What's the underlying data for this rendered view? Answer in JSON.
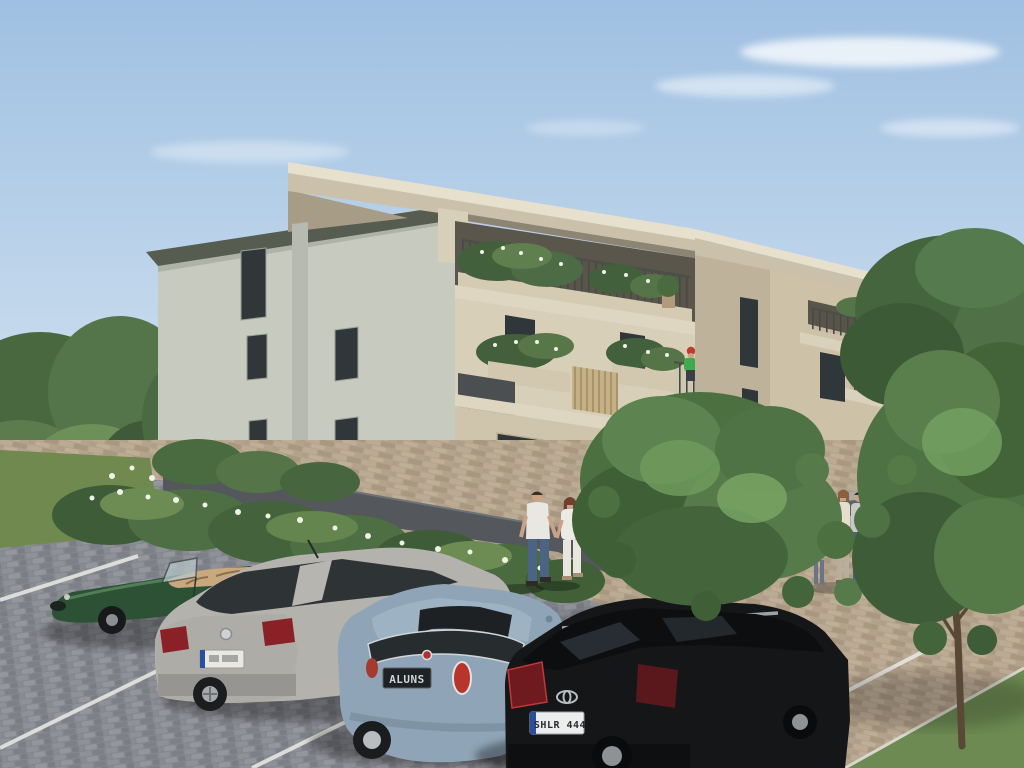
{
  "meta": {
    "type": "architectural-exterior-rendering",
    "title": "3D rendering of a modern three-storey apartment building with landscaped parking area",
    "time_of_day": "sunny daytime, light from upper right"
  },
  "palette": {
    "sky_top": "#9fc0e2",
    "sky_horizon": "#dce9f4",
    "cloud": "#ffffff",
    "building_left_facade": "#c7cabf",
    "building_front_lit": "#d8cfb8",
    "building_front_shade": "#cfc5ac",
    "building_far_wing": "#cdc1a8",
    "spine_wall": "#bfb29a",
    "roof_fascia_beige": "#cbc1aa",
    "roof_top_light": "#e7e0cc",
    "dark_eave_fascia": "#565c50",
    "window_dark": "#30373a",
    "anthracite_parapet": "#4b4f52",
    "wood_slats": "#c6b186",
    "railing": "#454a45",
    "base_plinth_wall": "#54575b",
    "pavement_grey": "#85878e",
    "pavement_tan": "#b3a28c",
    "stall_line_white": "#e6e6e2",
    "grass": "#70894f",
    "foliage_dark": "#3f5c38",
    "foliage_mid": "#547549",
    "foliage_light": "#74a05f",
    "flower_white": "#eef3e6",
    "trunk_brown": "#5d4a38",
    "shadow": "#000000"
  },
  "building": {
    "storeys": 3,
    "style": "contemporary flat overhanging roof slab, recessed loggias",
    "left_facade": {
      "color_name": "pale grey-green stucco",
      "windows": "five narrow dark vertical windows",
      "downspout_pillar": true
    },
    "front_facade": {
      "color_name": "warm beige stucco",
      "wings": 2
    },
    "balconies": {
      "railing": "thin dark metal balusters",
      "planters": "lush green shrubs with white blooms",
      "features": [
        "anthracite parapet panels",
        "vertical wood-slat privacy screens",
        "terracotta potted plants"
      ]
    },
    "plinth": {
      "color_name": "dark anthracite retaining wall",
      "hedge": "green hedge with white flowers in front"
    },
    "person_on_balcony": {
      "floor": "second",
      "shirt": "green",
      "cap": "red",
      "activity": "tending balcony plants"
    }
  },
  "vehicles": [
    {
      "name": "classic roadster",
      "style": "Jaguar E-Type-like convertible, top down",
      "color_name": "british racing green",
      "hex": "#2d5134",
      "interior": "tan leather",
      "facing": "left",
      "position": "far left stall"
    },
    {
      "name": "hatchback",
      "style": "VW Golf-like, rear three-quarter view",
      "color_name": "silver",
      "hex": "#b4b2ad",
      "position": "second stall",
      "license_plate": {
        "text": "",
        "background": "white",
        "euro_band": true,
        "legible": false
      }
    },
    {
      "name": "city car",
      "style": "Fiat 500-like, rear view, sunroof open",
      "color_name": "light steel blue",
      "hex": "#8fa5b7",
      "position": "third stall",
      "badge": "red Fiat-style emblem",
      "license_plate": {
        "text": "ALUNS",
        "background": "black",
        "legible": false
      }
    },
    {
      "name": "compact SUV",
      "style": "Toyota crossover, rear three-quarter view, roof rails",
      "color_name": "black",
      "hex": "#151618",
      "position": "fourth stall",
      "badge": "Toyota emblem",
      "license_plate": {
        "text": "SHLR 444",
        "background": "white",
        "euro_band": true,
        "legible": false
      }
    },
    {
      "name": "background parked car",
      "style": "mostly hidden behind tree and people",
      "color_name": "silver grey",
      "hex": "#a9aba8",
      "position": "upper right walkway"
    }
  ],
  "people": [
    {
      "who": "man of walking couple",
      "top": "white t-shirt",
      "bottom": "blue jeans",
      "action": "walking toward entrance holding hands"
    },
    {
      "who": "woman of walking couple",
      "top": "white top",
      "bottom": "white trousers",
      "accessory": "brown shoulder bag",
      "hair": "auburn"
    },
    {
      "who": "standing woman (group)",
      "top": "cream top",
      "location": "right walkway by parked car"
    },
    {
      "who": "standing man (group)",
      "top": "light grey t-shirt",
      "bottom": "dark jeans",
      "location": "right walkway"
    },
    {
      "who": "child (group)",
      "location": "beside standing couple, partly hidden"
    },
    {
      "who": "resident on balcony",
      "top": "green t-shirt",
      "hat": "red cap"
    }
  ],
  "vegetation": {
    "foreground_trees": 2,
    "tree_type": "young deciduous trees with round canopies",
    "left_planting": "tall shrubs with white flowering bush",
    "hedge": "flowering hedge row along building plinth",
    "background": "dense tree line on both sides"
  },
  "ground": {
    "parking_surface": "grey cobblestone pavers",
    "walkway_surface": "tan pavers",
    "markings": "white diagonal parking stall lines",
    "grass": [
      "lawn strip at left",
      "grass wedge at bottom right with tree"
    ]
  }
}
